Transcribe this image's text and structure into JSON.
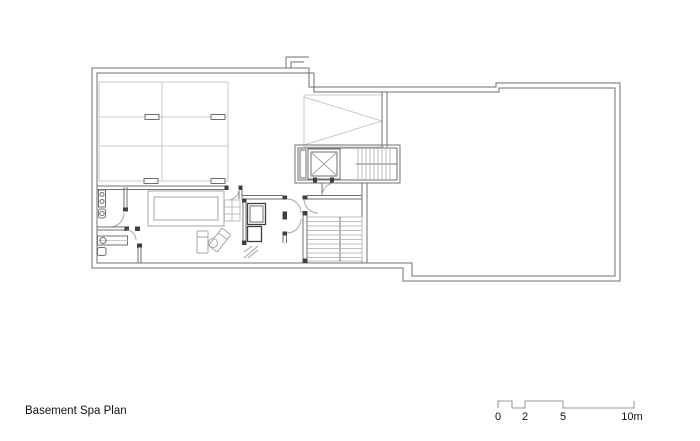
{
  "title": {
    "label": "Basement Spa Plan"
  },
  "scale_bar": {
    "label_0": "0",
    "label_2": "2",
    "label_5": "5",
    "label_10": "10m"
  },
  "colors": {
    "wall": "#6f6f6f",
    "dark": "#3f3f3f",
    "light": "#c9c9c9",
    "medium": "#a5a5a5",
    "tread": "#bdbdbd",
    "scalebar": "#9a9a9a",
    "text": "#111111",
    "background": "#ffffff"
  }
}
